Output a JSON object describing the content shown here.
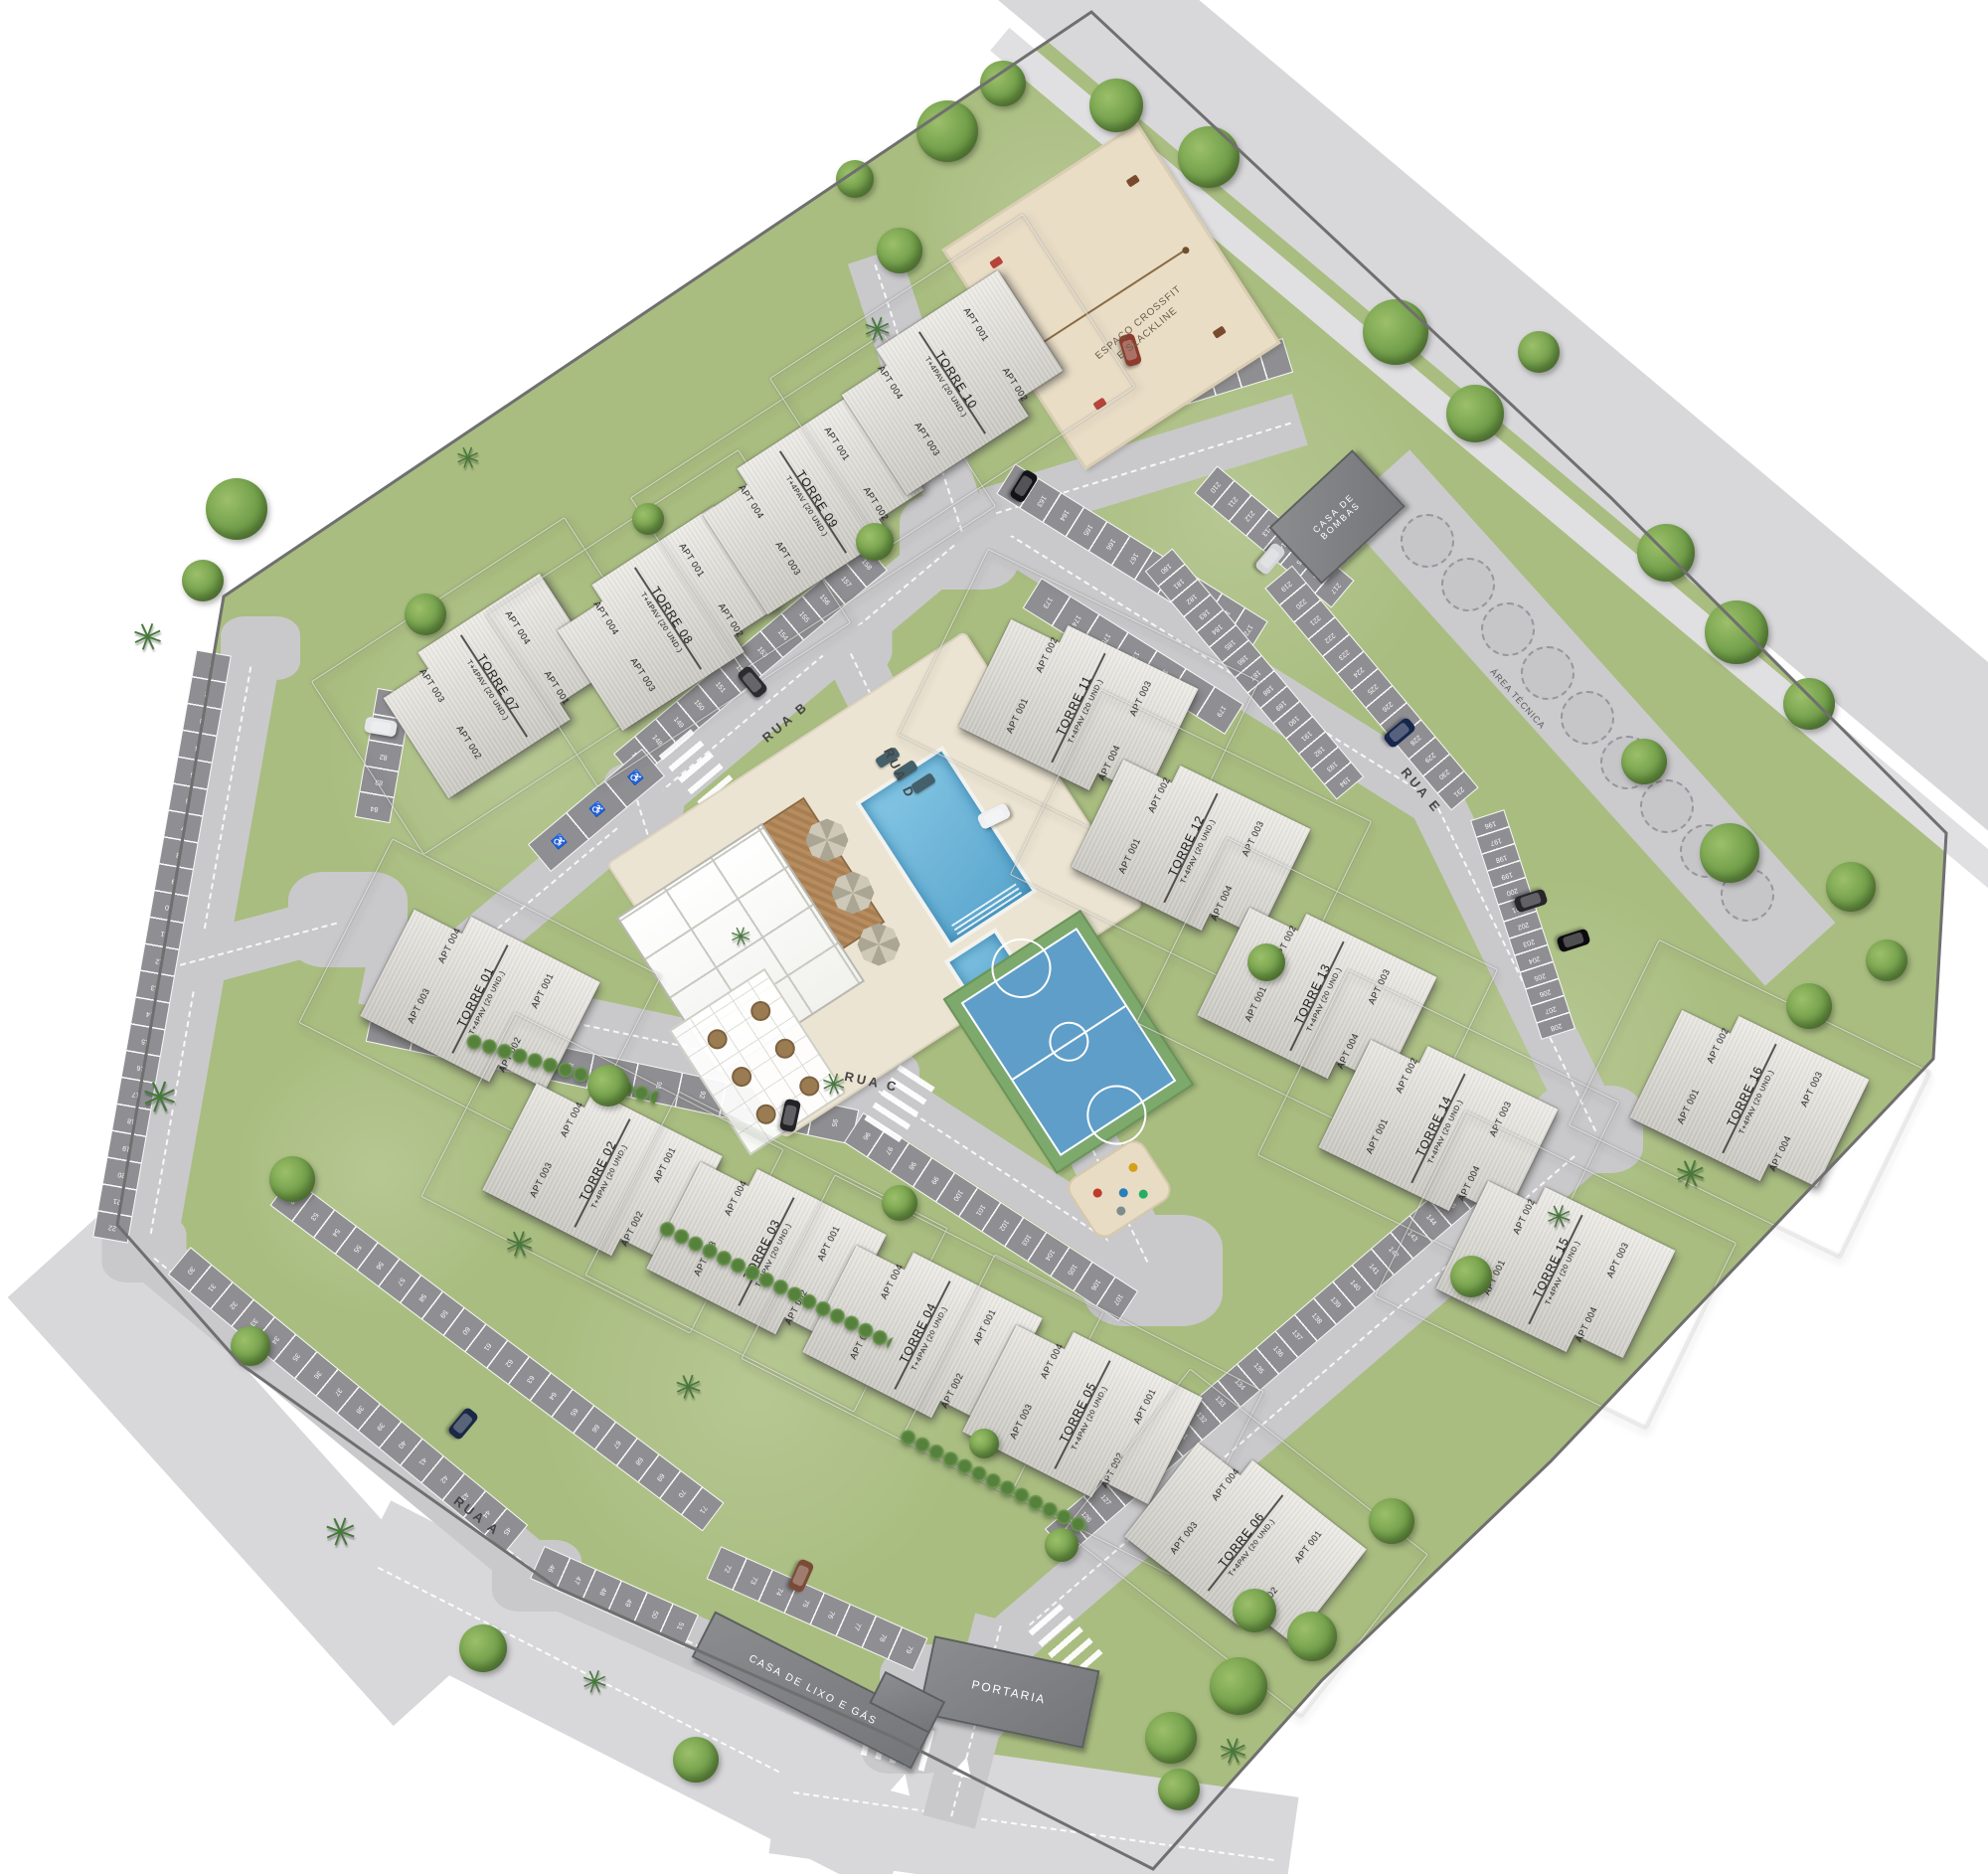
{
  "roads": {
    "a": "RUA A",
    "b": "RUA B",
    "c": "RUA C",
    "d": "RUA D",
    "e": "RUA E"
  },
  "places": {
    "portaria": "PORTARIA",
    "casa_de_lixo_e_gas": "CASA DE LIXO E GÁS",
    "casa_de_bombas_l1": "CASA DE",
    "casa_de_bombas_l2": "BOMBAS",
    "area_tecnica": "ÁREA TÉCNICA",
    "espaco_crossfit_l1": "ESPAÇO CROSSFIT",
    "espaco_crossfit_l2": "E SLACKLINE"
  },
  "tower_spec": "T+4PAV (20 UND.)",
  "towers": [
    {
      "name": "TORRE 01",
      "tl": "APT 004",
      "tr": "APT 001",
      "bl": "APT 003",
      "br": "APT 002"
    },
    {
      "name": "TORRE 02",
      "tl": "APT 004",
      "tr": "APT 001",
      "bl": "APT 003",
      "br": "APT 002"
    },
    {
      "name": "TORRE 03",
      "tl": "APT 004",
      "tr": "APT 001",
      "bl": "APT 003",
      "br": "APT 002"
    },
    {
      "name": "TORRE 04",
      "tl": "APT 004",
      "tr": "APT 001",
      "bl": "APT 003",
      "br": "APT 002"
    },
    {
      "name": "TORRE 05",
      "tl": "APT 004",
      "tr": "APT 001",
      "bl": "APT 003",
      "br": "APT 002"
    },
    {
      "name": "TORRE 06",
      "tl": "APT 004",
      "tr": "APT 001",
      "bl": "APT 003",
      "br": "APT 002"
    },
    {
      "name": "TORRE 07",
      "tl": "APT 003",
      "tr": "APT 004",
      "bl": "APT 002",
      "br": "APT 001"
    },
    {
      "name": "TORRE 08",
      "tl": "APT 004",
      "tr": "APT 001",
      "bl": "APT 003",
      "br": "APT 002"
    },
    {
      "name": "TORRE 09",
      "tl": "APT 004",
      "tr": "APT 001",
      "bl": "APT 003",
      "br": "APT 002"
    },
    {
      "name": "TORRE 10",
      "tl": "APT 004",
      "tr": "APT 001",
      "bl": "APT 003",
      "br": "APT 002"
    },
    {
      "name": "TORRE 11",
      "tl": "APT 002",
      "tr": "APT 003",
      "bl": "APT 001",
      "br": "APT 004"
    },
    {
      "name": "TORRE 12",
      "tl": "APT 002",
      "tr": "APT 003",
      "bl": "APT 001",
      "br": "APT 004"
    },
    {
      "name": "TORRE 13",
      "tl": "APT 002",
      "tr": "APT 003",
      "bl": "APT 001",
      "br": "APT 004"
    },
    {
      "name": "TORRE 14",
      "tl": "APT 002",
      "tr": "APT 003",
      "bl": "APT 001",
      "br": "APT 004"
    },
    {
      "name": "TORRE 15",
      "tl": "APT 002",
      "tr": "APT 003",
      "bl": "APT 001",
      "br": "APT 004"
    },
    {
      "name": "TORRE 16",
      "tl": "APT 002",
      "tr": "APT 003",
      "bl": "APT 001",
      "br": "APT 004"
    }
  ],
  "parking": {
    "accessible_symbol": "♿",
    "strips": [
      {
        "id": "left-edge",
        "from": 1,
        "to": 22
      },
      {
        "id": "rua-a-outer-1",
        "from": 30,
        "to": 45
      },
      {
        "id": "rua-a-outer-2",
        "from": 46,
        "to": 51
      },
      {
        "id": "rua-a-inner-1",
        "from": 52,
        "to": 71
      },
      {
        "id": "rua-a-inner-2",
        "from": 72,
        "to": 79
      },
      {
        "id": "torre01-pocket",
        "from": 80,
        "to": 84
      },
      {
        "id": "rua-c-south-1",
        "from": 85,
        "to": 95
      },
      {
        "id": "rua-c-south-2",
        "from": 96,
        "to": 107
      },
      {
        "id": "rua-d-east",
        "from": 110,
        "to": 123
      },
      {
        "id": "se-road-north",
        "from": 125,
        "to": 146
      },
      {
        "id": "rua-b-north",
        "from": 147,
        "to": 158
      },
      {
        "id": "rua-e-north-1",
        "from": 162,
        "to": 172
      },
      {
        "id": "rua-e-south-1",
        "from": 173,
        "to": 179
      },
      {
        "id": "rua-e-west",
        "from": 180,
        "to": 194
      },
      {
        "id": "right-edge",
        "from": 196,
        "to": 208
      },
      {
        "id": "rua-e-east-1",
        "from": 210,
        "to": 217
      },
      {
        "id": "rua-e-east-2",
        "from": 219,
        "to": 231
      }
    ]
  },
  "colors": {
    "grass": "#a9bd80",
    "road": "#c9c9cc",
    "external_road": "#d8d8da",
    "parking": "#8f8f93",
    "tower_fill": "#e4e2dc",
    "service_building": "#7d7f82",
    "pool": "#6db3d9",
    "court": "#5f9ec8",
    "court_border": "#7da96c",
    "sand": "#e9ddc6",
    "terrace": "#ece4d2",
    "deck": "#b3895c"
  }
}
